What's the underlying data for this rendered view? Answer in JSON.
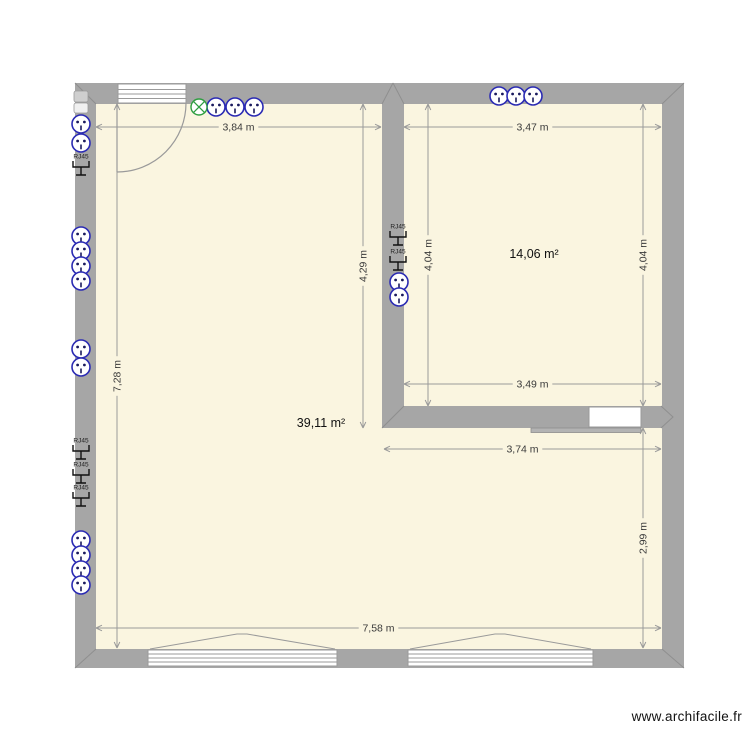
{
  "watermark": "www.archifacile.fr",
  "plan": {
    "colors": {
      "wall": "#a6a6a6",
      "wall_seam": "#8f8f8f",
      "floor": "#faf5e0",
      "dim_line": "#9a9a9a",
      "dim_text": "#3a3a3a",
      "outlet_blue": "#2b2bb3",
      "outlet_pin": "#1a1a5e",
      "light_green": "#2f9e41",
      "opening_stroke": "#9a9a9a"
    },
    "rooms": [
      {
        "label": "39,11 m²",
        "x": 321,
        "y": 427
      },
      {
        "label": "14,06 m²",
        "x": 534,
        "y": 258
      }
    ],
    "dimensions": [
      {
        "text": "3,84 m",
        "orient": "h",
        "x1": 96,
        "x2": 381,
        "y": 127
      },
      {
        "text": "3,47 m",
        "orient": "h",
        "x1": 404,
        "x2": 661,
        "y": 127
      },
      {
        "text": "7,28 m",
        "orient": "v",
        "x": 117,
        "y1": 104,
        "y2": 648
      },
      {
        "text": "4,29 m",
        "orient": "v",
        "x": 363,
        "y1": 104,
        "y2": 428
      },
      {
        "text": "4,04 m",
        "orient": "v",
        "x": 428,
        "y1": 104,
        "y2": 406
      },
      {
        "text": "4,04 m",
        "orient": "v",
        "x": 643,
        "y1": 104,
        "y2": 406
      },
      {
        "text": "3,49 m",
        "orient": "h",
        "x1": 404,
        "x2": 661,
        "y": 384
      },
      {
        "text": "3,74 m",
        "orient": "h",
        "x1": 384,
        "x2": 661,
        "y": 449
      },
      {
        "text": "2,99 m",
        "orient": "v",
        "x": 643,
        "y1": 428,
        "y2": 648
      },
      {
        "text": "7,58 m",
        "orient": "h",
        "x1": 96,
        "x2": 661,
        "y": 628
      }
    ],
    "outlets": [
      {
        "x": 81,
        "y": 124
      },
      {
        "x": 81,
        "y": 143
      },
      {
        "x": 81,
        "y": 236
      },
      {
        "x": 81,
        "y": 251
      },
      {
        "x": 81,
        "y": 266
      },
      {
        "x": 81,
        "y": 281
      },
      {
        "x": 81,
        "y": 349
      },
      {
        "x": 81,
        "y": 367
      },
      {
        "x": 81,
        "y": 540
      },
      {
        "x": 81,
        "y": 555
      },
      {
        "x": 81,
        "y": 570
      },
      {
        "x": 81,
        "y": 585
      },
      {
        "x": 216,
        "y": 107
      },
      {
        "x": 235,
        "y": 107
      },
      {
        "x": 254,
        "y": 107
      },
      {
        "x": 499,
        "y": 96
      },
      {
        "x": 516,
        "y": 96
      },
      {
        "x": 533,
        "y": 96
      },
      {
        "x": 399,
        "y": 282
      },
      {
        "x": 399,
        "y": 297
      }
    ],
    "rj45_label": "RJ45",
    "rj45": [
      {
        "x": 81,
        "y": 167
      },
      {
        "x": 81,
        "y": 451
      },
      {
        "x": 81,
        "y": 475
      },
      {
        "x": 81,
        "y": 498
      },
      {
        "x": 398,
        "y": 237
      },
      {
        "x": 398,
        "y": 262
      }
    ],
    "light": {
      "x": 199,
      "y": 107
    }
  }
}
